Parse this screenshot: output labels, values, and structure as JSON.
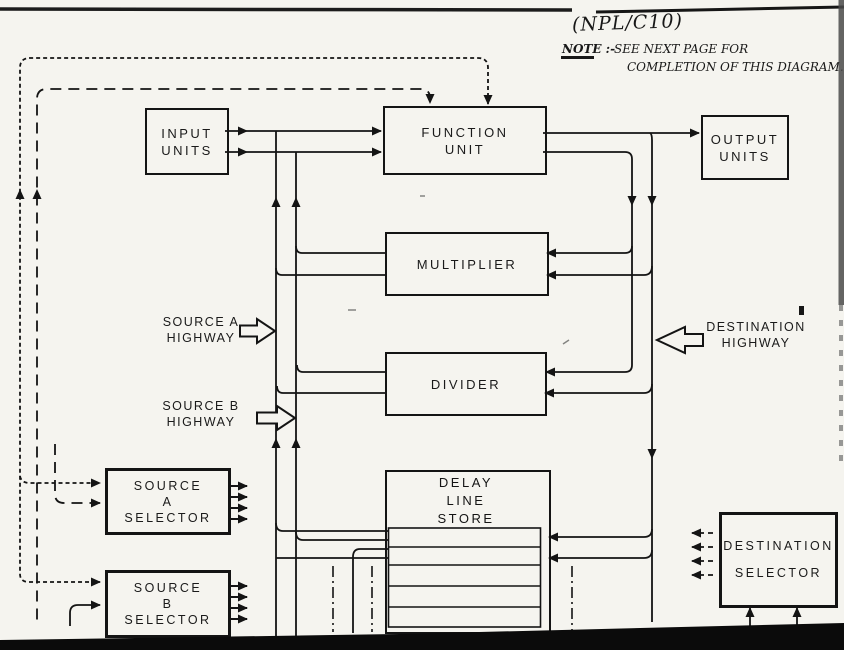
{
  "page": {
    "paper_color": "#f5f4ef",
    "ink_color": "#141414"
  },
  "annotation": {
    "ref": "(NPL/C10)",
    "note_label": "NOTE :-",
    "note_text": "SEE NEXT PAGE FOR",
    "note_text2": "COMPLETION OF THIS DIAGRAM."
  },
  "boxes": {
    "input_units": {
      "line1": "INPUT",
      "line2": "UNITS"
    },
    "function_unit": {
      "line1": "FUNCTION",
      "line2": "UNIT"
    },
    "output_units": {
      "line1": "OUTPUT",
      "line2": "UNITS"
    },
    "multiplier": {
      "line1": "MULTIPLIER"
    },
    "divider": {
      "line1": "DIVIDER"
    },
    "delay_line_store": {
      "line1": "DELAY",
      "line2": "LINE",
      "line3": "STORE"
    },
    "source_a_selector": {
      "line1": "SOURCE",
      "line2": "A",
      "line3": "SELECTOR"
    },
    "source_b_selector": {
      "line1": "SOURCE",
      "line2": "B",
      "line3": "SELECTOR"
    },
    "destination_selector": {
      "line1": "DESTINATION",
      "line2": "SELECTOR"
    }
  },
  "highways": {
    "source_a": {
      "line1": "SOURCE  A",
      "line2": "HIGHWAY"
    },
    "source_b": {
      "line1": "SOURCE  B",
      "line2": "HIGHWAY"
    },
    "destination": {
      "line1": "DESTINATION",
      "line2": "HIGHWAY"
    }
  }
}
